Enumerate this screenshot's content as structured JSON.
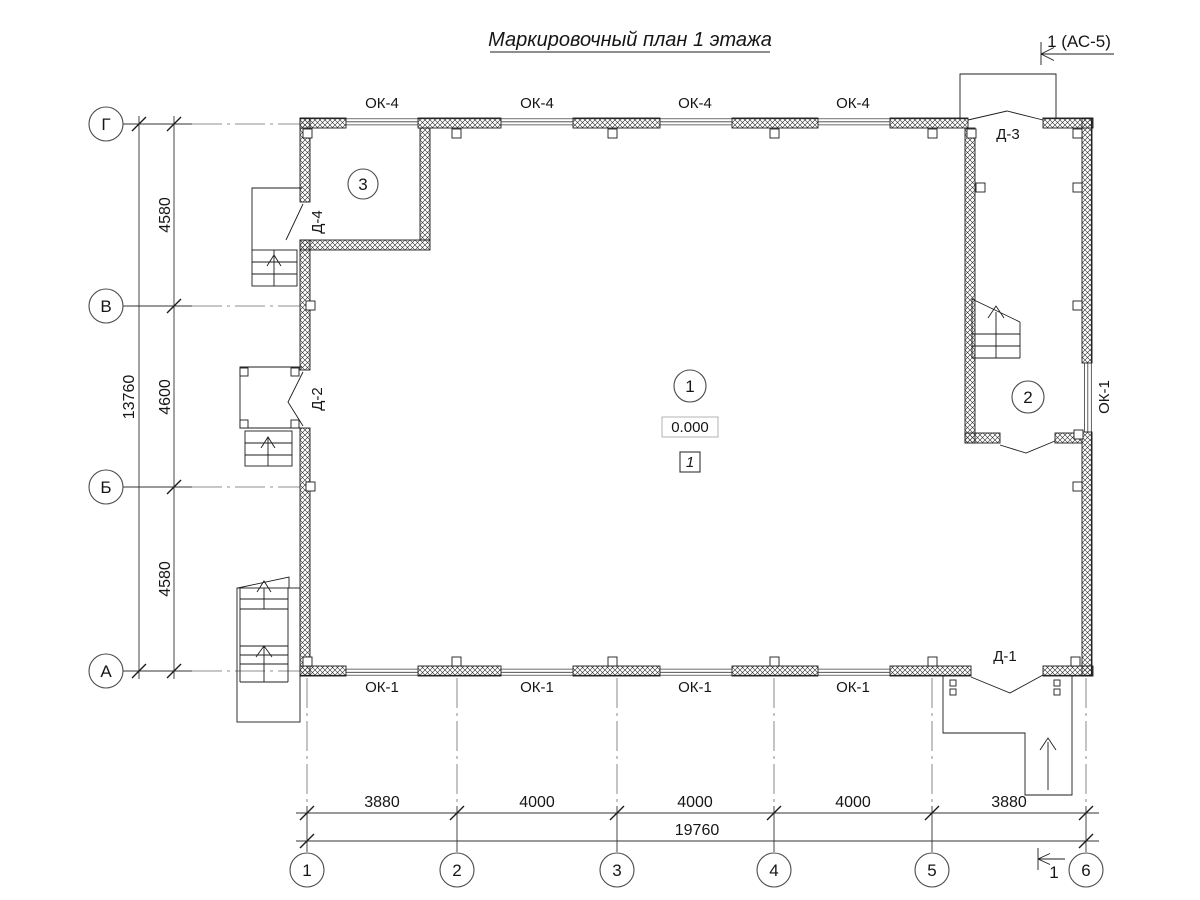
{
  "title": "Маркировочный план 1 этажа",
  "section_marks": {
    "top": "1 (АС-5)",
    "bottom": "1"
  },
  "row_axes": [
    "Г",
    "В",
    "Б",
    "А"
  ],
  "col_axes": [
    "1",
    "2",
    "3",
    "4",
    "5",
    "6"
  ],
  "dims_left": {
    "segments": [
      "4580",
      "4600",
      "4580"
    ],
    "total": "13760"
  },
  "dims_bottom": {
    "segments": [
      "3880",
      "4000",
      "4000",
      "4000",
      "3880"
    ],
    "total": "19760"
  },
  "windows": {
    "top": [
      "ОК-4",
      "ОК-4",
      "ОК-4",
      "ОК-4"
    ],
    "bottom": [
      "ОК-1",
      "ОК-1",
      "ОК-1",
      "ОК-1"
    ],
    "right": "ОК-1"
  },
  "doors": {
    "d1": "Д-1",
    "d2": "Д-2",
    "d3": "Д-3",
    "d4": "Д-4"
  },
  "rooms": {
    "r1": "1",
    "r2": "2",
    "r3": "3"
  },
  "elevation": "0.000",
  "plan_note": "1",
  "colors": {
    "ink": "#1c1c1c",
    "dim_lines": "#333333",
    "axis_lines": "#6b6b6b",
    "elevation_box": "#b3b3b3"
  }
}
